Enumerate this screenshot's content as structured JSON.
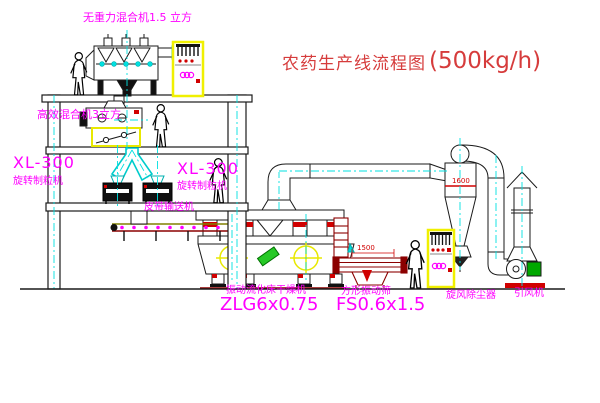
{
  "diagram": {
    "title": "农药生产线流程图",
    "capacity": "(500kg/h)"
  },
  "labels": {
    "gravity_mixer": "无重力混合机1.5 立方",
    "high_eff_mixer": "高效混合机3立方",
    "granulator_left_model": "XL-300",
    "granulator_left_name": "旋转制粒机",
    "granulator_right_model": "XL-300",
    "granulator_right_name": "旋转制粒机",
    "belt_conveyor": "皮带输送机",
    "dryer_name": "振动流化床干燥机",
    "dryer_model": "ZLG6x0.75",
    "screen_name": "方形振动筛",
    "screen_model": "FS0.6x1.5",
    "cyclone": "旋风除尘器",
    "fan": "引风机"
  },
  "dimensions": {
    "screen_length": "1500",
    "cyclone_dia": "1600"
  },
  "colors": {
    "label_magenta": "#ff00ff",
    "title_red": "#d63c3c",
    "machine_yellow": "#f0f000",
    "centerline_cyan": "#00e0e0",
    "screen_maroon": "#8b0000"
  }
}
